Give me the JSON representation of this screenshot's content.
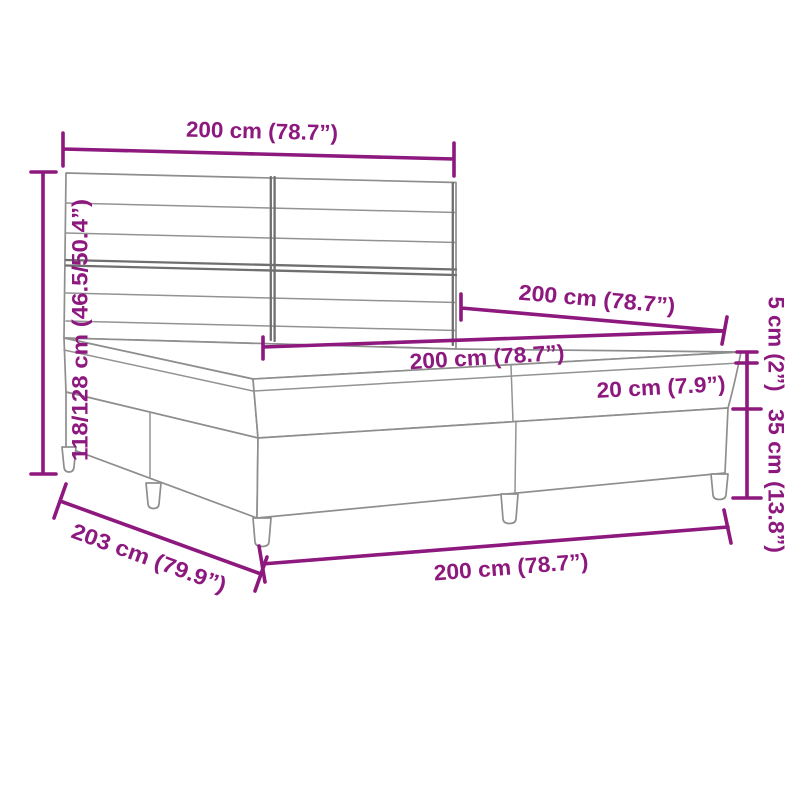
{
  "diagram": {
    "kind": "furniture-dimension-diagram",
    "subject": "box-spring-bed-with-headboard",
    "colors": {
      "dimension_accent": "#8d187e",
      "line_art": "#8e8e8e",
      "background": "#ffffff"
    },
    "dims": {
      "headboard_width": {
        "label": "200 cm (78.7”)"
      },
      "total_height": {
        "label": "118/128 cm (46.5/50.4”)"
      },
      "bed_length_top": {
        "label": "200 cm (78.7”)"
      },
      "mattress_width": {
        "label": "200 cm (78.7”)"
      },
      "mattress_thickness": {
        "label": "20 cm (7.9”)"
      },
      "topper_thickness": {
        "label": "5 cm (2”)"
      },
      "base_height": {
        "label": "35 cm (13.8”)"
      },
      "base_length": {
        "label": "203 cm (79.9”)"
      },
      "base_width": {
        "label": "200 cm (78.7”)"
      }
    }
  }
}
